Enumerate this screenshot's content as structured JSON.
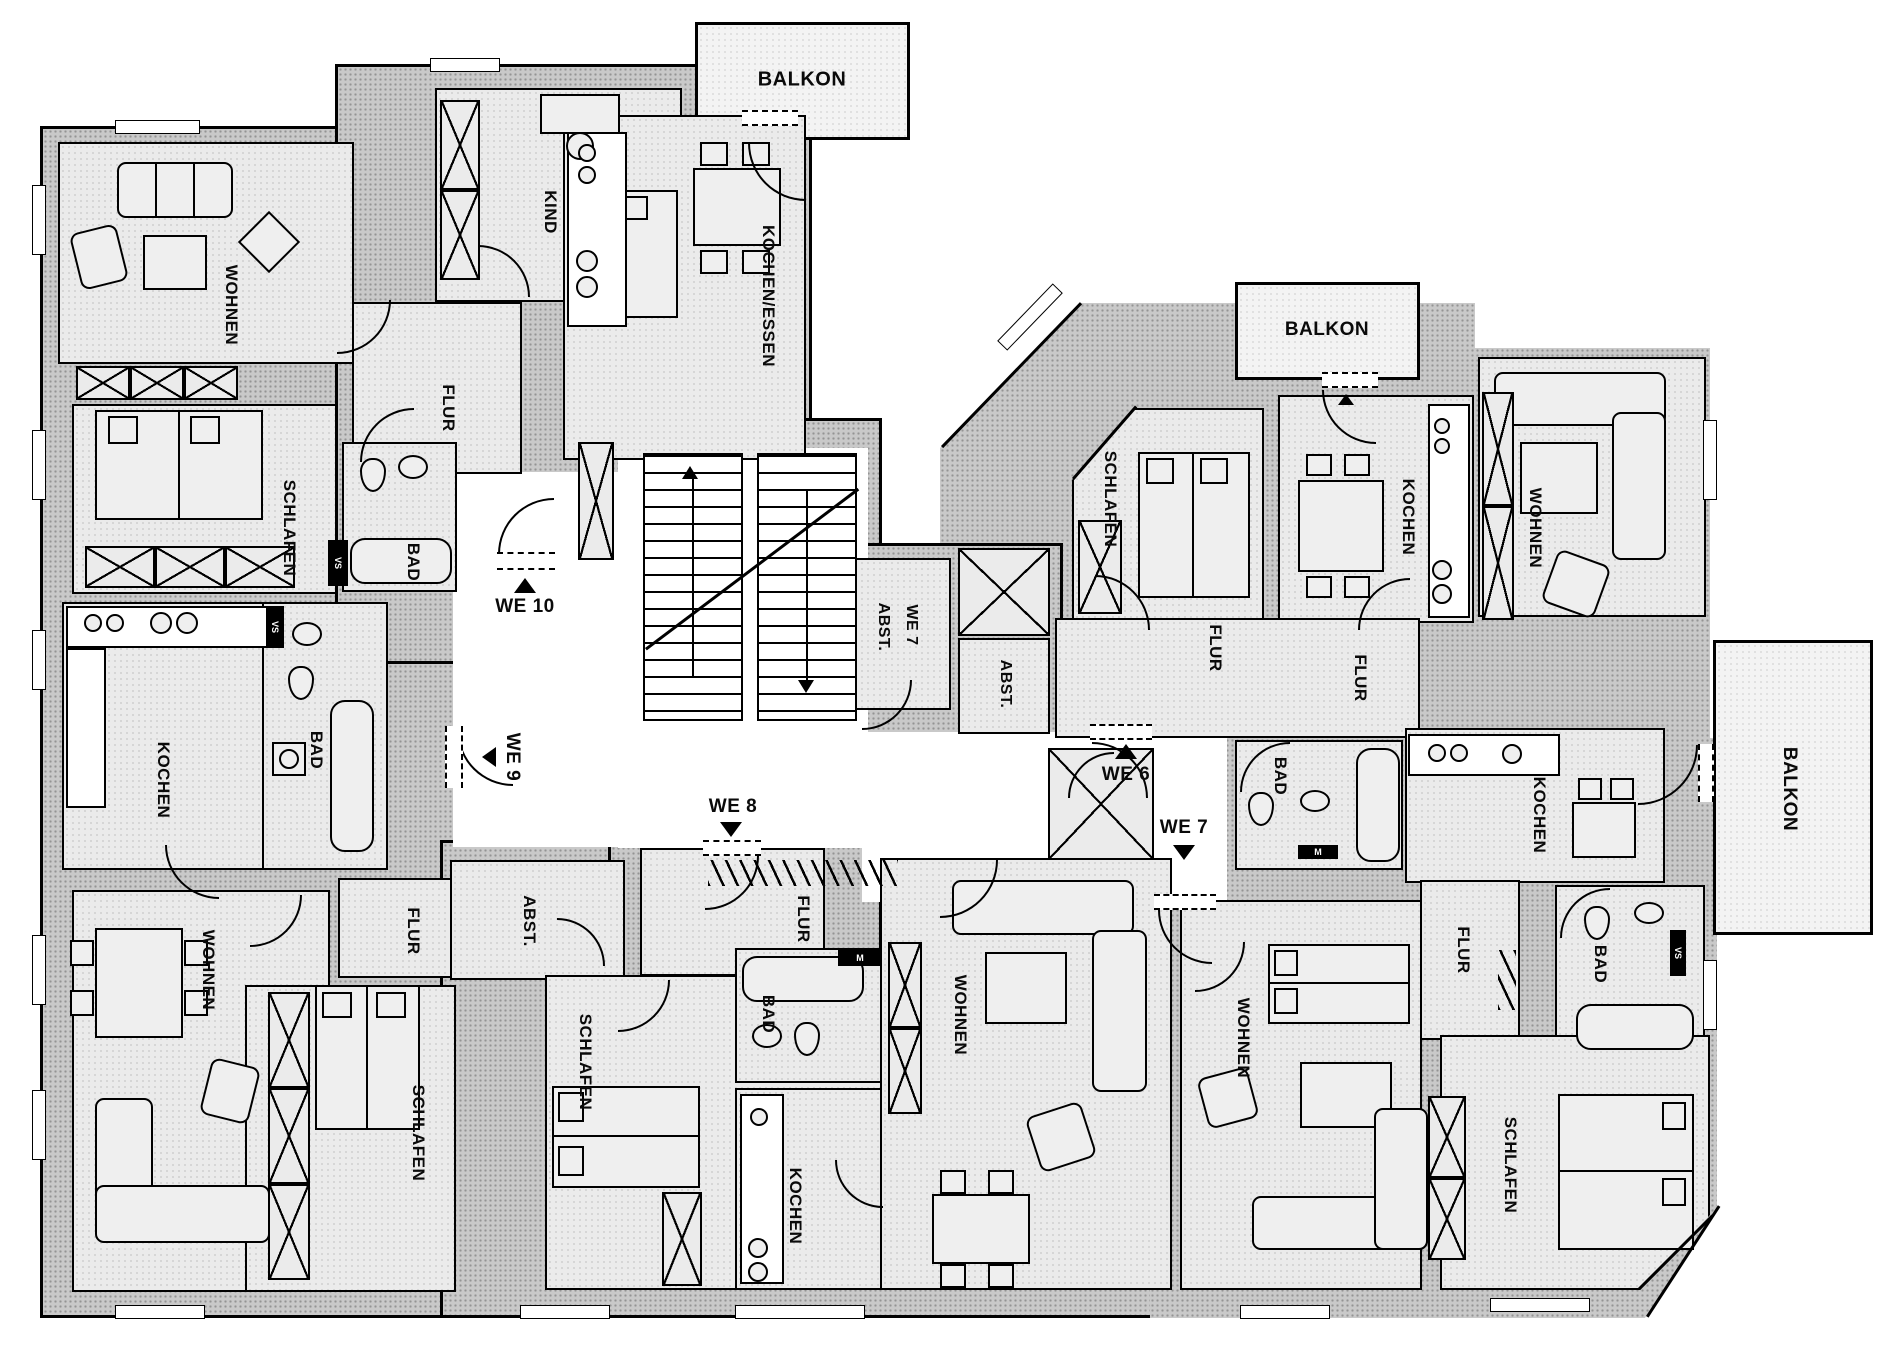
{
  "plan": {
    "type": "floor-plan",
    "language": "de",
    "apartments": {
      "we10": {
        "label": "WE 10",
        "rooms": {
          "wohnen": "WOHNEN",
          "kind": "KIND",
          "flur": "FLUR",
          "schlafen": "SCHLAFEN",
          "bad": "BAD",
          "kochen_essen": "KOCHEN/ESSEN",
          "balkon": "BALKON"
        }
      },
      "we9": {
        "label": "WE 9",
        "rooms": {
          "kochen": "KOCHEN",
          "bad": "BAD",
          "wohnen": "WOHNEN",
          "flur": "FLUR",
          "schlafen": "SCHLAFEN"
        }
      },
      "we8": {
        "label": "WE 8",
        "rooms": {
          "abst": "ABST.",
          "flur": "FLUR",
          "schlafen": "SCHLAFEN",
          "bad": "BAD",
          "kochen": "KOCHEN",
          "wohnen": "WOHNEN"
        }
      },
      "we6": {
        "label": "WE 6",
        "rooms": {
          "schlafen": "SCHLAFEN",
          "kochen": "KOCHEN",
          "wohnen": "WOHNEN",
          "flur": "FLUR",
          "flur2": "FLUR",
          "bad": "BAD",
          "abst": "ABST.",
          "balkon": "BALKON"
        }
      },
      "we7": {
        "label": "WE 7",
        "rooms": {
          "abst_line1": "ABST.",
          "abst_line2": "WE 7",
          "wohnen": "WOHNEN",
          "kochen": "KOCHEN",
          "flur": "FLUR",
          "bad": "BAD",
          "schlafen": "SCHLAFEN",
          "balkon": "BALKON"
        }
      }
    },
    "markers": {
      "vs": "VS",
      "m": "M"
    }
  }
}
